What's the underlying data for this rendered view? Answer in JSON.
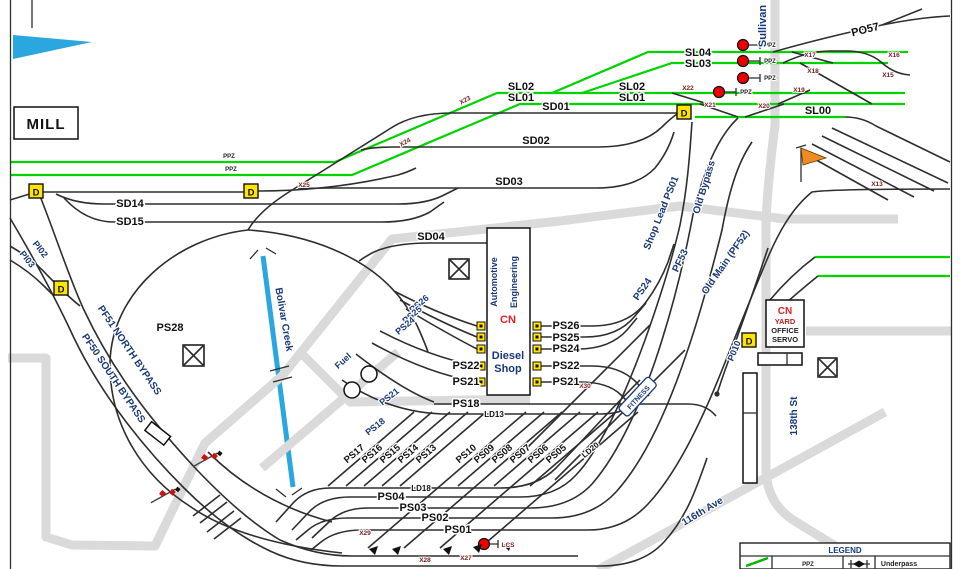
{
  "colors": {
    "track_green": "#00d400",
    "creek_blue": "#2aa7df",
    "signal_red": "#ee0000",
    "detector_yellow": "#ffe500",
    "street_navy": "#17387b",
    "road_gray": "#dadada",
    "cn_red": "#e31f26"
  },
  "lbl": {
    "mill": "MILL",
    "ppz": "PPZ",
    "po57": "PO57",
    "sullivan": "Sullivan",
    "sl00": "SL00",
    "sl01": "SL01",
    "sl02": "SL02",
    "sl03": "SL03",
    "sl04": "SL04",
    "sd01": "SD01",
    "sd02": "SD02",
    "sd03": "SD03",
    "sd04": "SD04",
    "sd14": "SD14",
    "sd15": "SD15",
    "x13": "X13",
    "x15": "X15",
    "x16": "X16",
    "x17": "X17",
    "x18": "X18",
    "x19": "X19",
    "x20": "X20",
    "x21": "X21",
    "x22": "X22",
    "x23": "X23",
    "x24": "X24",
    "x25": "X25",
    "x27": "X27",
    "x28": "X28",
    "x29": "X29",
    "x30": "X30",
    "pi02": "PI02",
    "pi03": "PI03",
    "pf51": "PF51 NORTH BYPASS",
    "pf50": "PF50 SOUTH BYPASS",
    "ps28": "PS28",
    "bolivar": "Bolivar Creek",
    "fuel": "Fuel",
    "automotive": "Automotive",
    "engineering": "Engineering",
    "cn": "CN",
    "diesel": "Diesel",
    "shop": "Shop",
    "ps26": "PS26",
    "ps25": "PS25",
    "ps24": "PS24",
    "ps22": "PS22",
    "ps21": "PS21",
    "shop_lead": "Shop Lead PS01",
    "pf53": "PF53",
    "old_bypass": "Old Bypass",
    "old_main": "Old Main (PF52)",
    "ps18": "PS18",
    "ld13": "LD13",
    "ld18": "LD18",
    "ld20": "LD20",
    "ps04": "PS04",
    "ps03": "PS03",
    "ps02": "PS02",
    "ps01": "PS01",
    "lcs": "LCS",
    "fitness": "FITNESS",
    "p010": "P010",
    "yard": "YARD",
    "office": "OFFICE",
    "servo": "SERVO",
    "st138": "138th St",
    "ave116": "116th Ave",
    "d": "D",
    "legend_title": "LEGEND",
    "underpass": "Underpass"
  },
  "ladder_left": [
    "PS17",
    "PS16",
    "PS15",
    "PS14",
    "PS13"
  ],
  "ladder_right": [
    "PS10",
    "PS09",
    "PS08",
    "PS07",
    "PS06",
    "PS05"
  ]
}
